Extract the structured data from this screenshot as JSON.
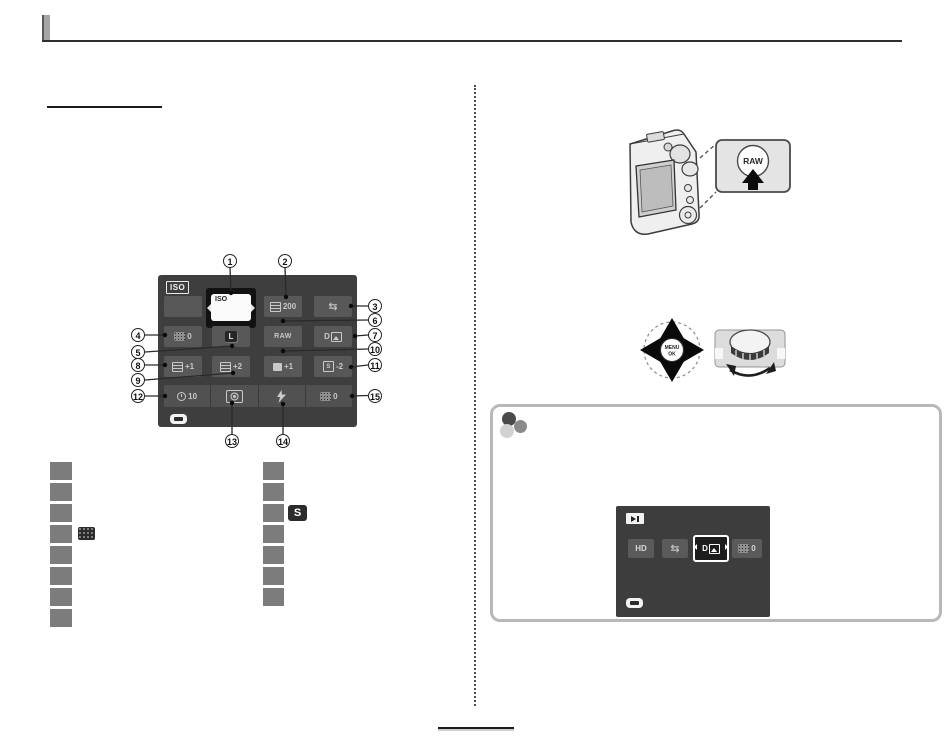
{
  "figure_quick_menu": {
    "screen": {
      "iso_badge": "ISO",
      "selected_label": "ISO",
      "r1c3_value": "200",
      "r2c1_value": "0",
      "r2c2_label": "L",
      "r2c3_label": "RAW",
      "dr_icon_label": "D",
      "r3c1_value": "+1",
      "r3c2_value": "+2",
      "r3c3_value": "+1",
      "r3c4_icon": "S",
      "r3c4_value": "-2",
      "r4_timer_value": "10",
      "r4c4_value": "0"
    },
    "callouts": [
      {
        "label": "1"
      },
      {
        "label": "2"
      },
      {
        "label": "3"
      },
      {
        "label": "4"
      },
      {
        "label": "5"
      },
      {
        "label": "6"
      },
      {
        "label": "7"
      },
      {
        "label": "8"
      },
      {
        "label": "9"
      },
      {
        "label": "10"
      },
      {
        "label": "11"
      },
      {
        "label": "12"
      },
      {
        "label": "13"
      },
      {
        "label": "14"
      },
      {
        "label": "15"
      }
    ]
  },
  "lists": {
    "sharpness_icon_label": "S"
  },
  "figure_raw_button": {
    "button_label": "RAW"
  },
  "figure_selector": {
    "center_line1": "MENU",
    "center_line2": "OK"
  },
  "note_box": {
    "screen": {
      "hd_label": "HD",
      "dr_icon_label": "D",
      "c4_value": "0"
    }
  }
}
